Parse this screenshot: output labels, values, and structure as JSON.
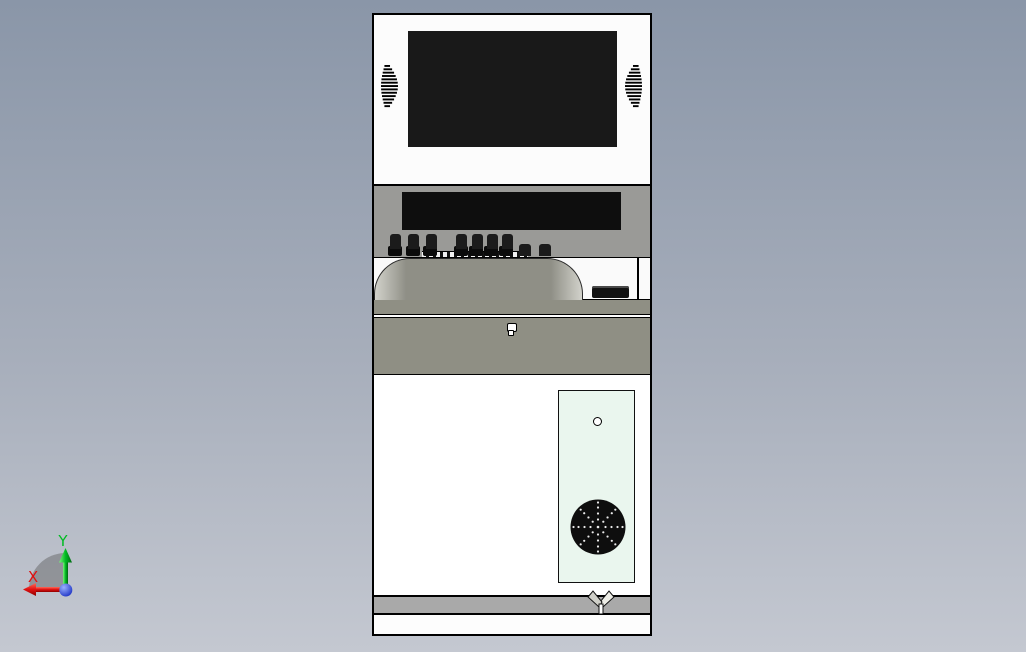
{
  "viewport": {
    "type": "cad-3d-front-view",
    "background_top": "#8A96A8",
    "background_bottom": "#C4C8D1"
  },
  "model": {
    "name": "kiosk-cabinet",
    "monitor": {
      "panel_color": "#FCFCFC",
      "screen_color": "#191919",
      "grille_color": "#000000"
    },
    "control_panel": {
      "panel_color": "#9A9A97",
      "display_color": "#0E0E0E",
      "key_color": "#1B1B1B",
      "tall_key_count": 7,
      "small_key_count": 2
    },
    "dome_bay": {
      "dome_color": "#8F8F86",
      "dome_highlight": "#D2D2CB",
      "button_color": "#121212"
    },
    "trim_band_color": "#8F8F84",
    "drawer": {
      "panel_color": "#8F8F84",
      "keyhole_color": "#FFFFFF"
    },
    "cabinet": {
      "body_color": "#FFFFFF",
      "vent_panel_color": "#EAF6EE",
      "fan_color": "#0E0E0E",
      "fan_dot_color": "#FFFFFF",
      "screw_hole_color": "#FFFFFF"
    },
    "base": {
      "strip_color": "#A9A9A9",
      "kick_color": "#FDFDFD",
      "foot_color": "#CFCFC8"
    }
  },
  "axis_triad": {
    "x_label": "X",
    "x_color": "#E01010",
    "y_label": "Y",
    "y_color": "#00BB22",
    "origin_color": "#2233DD",
    "sector_color": "#5A5A5A"
  }
}
